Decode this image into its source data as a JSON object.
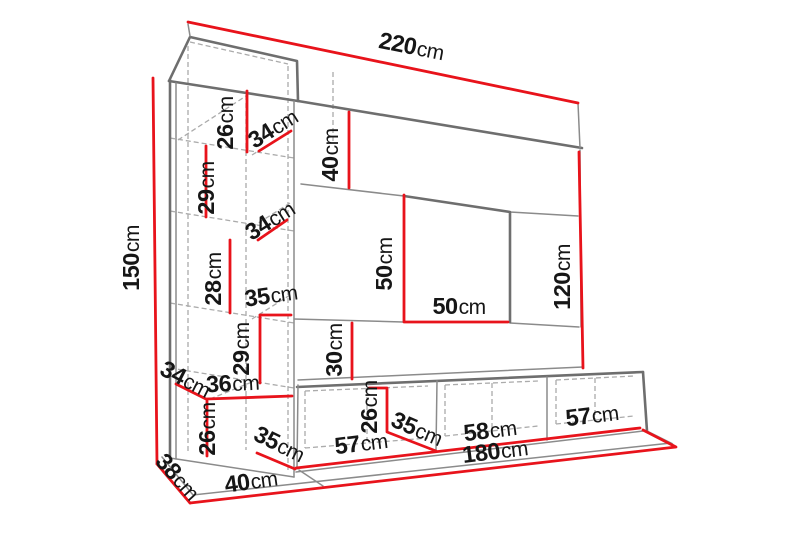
{
  "diagram": {
    "kind": "furniture-dimension-drawing",
    "subject": "wall unit with tall side cabinet, top cabinet, TV recess and three-door bench",
    "unit": "cm"
  },
  "colors": {
    "dimension": "#e8131b",
    "outline": "#6e6e6e",
    "outline_light": "#8b8b8b",
    "hidden": "#ababab",
    "label": "#161616",
    "background": "#ffffff"
  },
  "dimensions": {
    "total_width": {
      "value": "220",
      "unit": "cm"
    },
    "total_height": {
      "value": "150",
      "unit": "cm"
    },
    "tower_shelf_1_height": {
      "value": "26",
      "unit": "cm"
    },
    "tower_depth_top": {
      "value": "34",
      "unit": "cm"
    },
    "top_cabinet_height": {
      "value": "40",
      "unit": "cm"
    },
    "tower_shelf_2_height": {
      "value": "29",
      "unit": "cm"
    },
    "tower_depth_mid": {
      "value": "34",
      "unit": "cm"
    },
    "tower_shelf_3_height": {
      "value": "28",
      "unit": "cm"
    },
    "tower_shelf_width": {
      "value": "35",
      "unit": "cm"
    },
    "tower_shelf_4_height": {
      "value": "29",
      "unit": "cm"
    },
    "tv_recess_height": {
      "value": "50",
      "unit": "cm"
    },
    "tv_recess_width": {
      "value": "50",
      "unit": "cm"
    },
    "gap_above_bench": {
      "value": "30",
      "unit": "cm"
    },
    "right_side_height": {
      "value": "120",
      "unit": "cm"
    },
    "tower_depth_bottom": {
      "value": "34",
      "unit": "cm"
    },
    "tower_bottom_shelf_width": {
      "value": "36",
      "unit": "cm"
    },
    "tower_shelf_5_height": {
      "value": "26",
      "unit": "cm"
    },
    "tower_base_depth": {
      "value": "35",
      "unit": "cm"
    },
    "bench_height": {
      "value": "26",
      "unit": "cm"
    },
    "bench_depth": {
      "value": "35",
      "unit": "cm"
    },
    "bench_section_left": {
      "value": "57",
      "unit": "cm"
    },
    "bench_section_middle": {
      "value": "58",
      "unit": "cm"
    },
    "bench_section_right": {
      "value": "57",
      "unit": "cm"
    },
    "bench_total_width": {
      "value": "180",
      "unit": "cm"
    },
    "floor_left_width": {
      "value": "40",
      "unit": "cm"
    },
    "floor_depth": {
      "value": "38",
      "unit": "cm"
    }
  }
}
